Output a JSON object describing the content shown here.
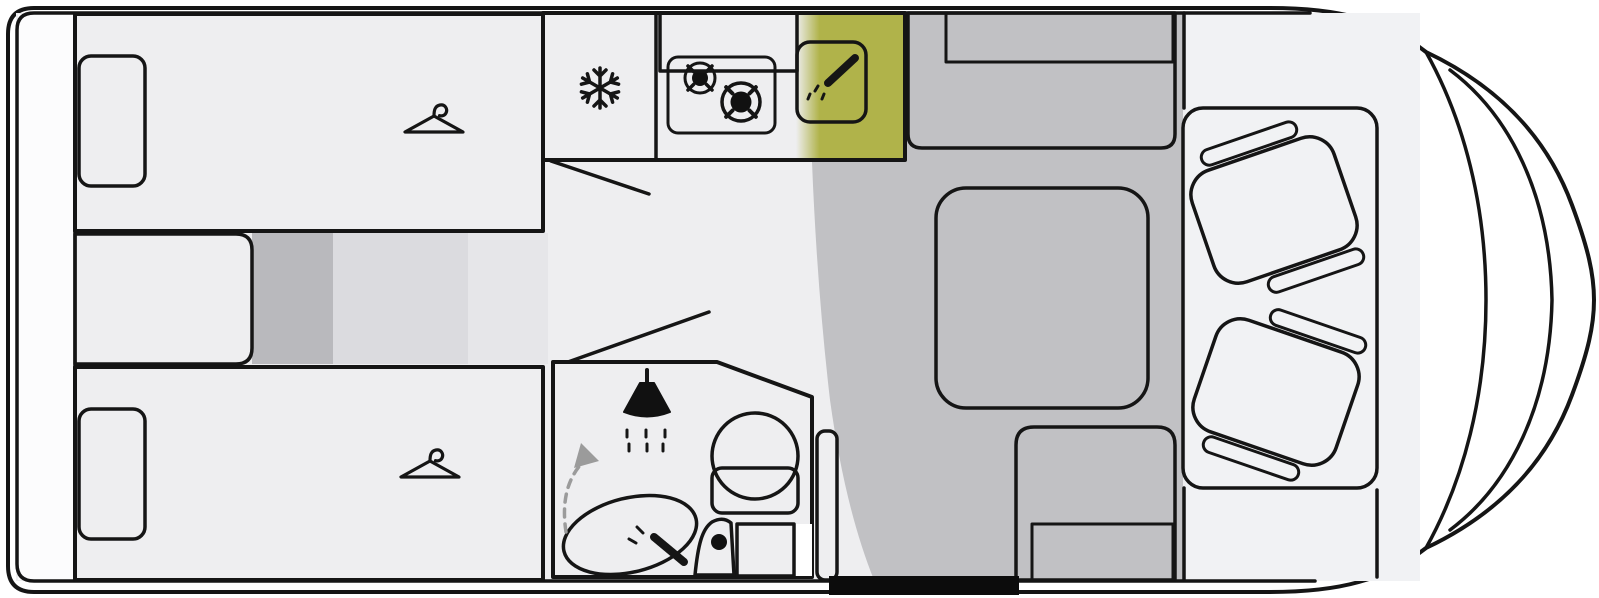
{
  "meta": {
    "title": "Motorhome floor plan",
    "view": "top-down layout diagram",
    "text_labels": []
  },
  "colors": {
    "shell": "#edeff0",
    "floor": "#eeeef0",
    "cab_floor": "#f1f2f4",
    "rear_floor": "#fcfcfd",
    "bed": "#f1f1d9",
    "step_band_dark": "#b9b9bd",
    "step_band_mid": "#dbdbdf",
    "step_band_light": "#e6e6e9",
    "kitchen": "#d5d860",
    "kitchen_shadow": "#b0b34a",
    "bathroom": "#e4e5a1",
    "dinette_floor": "#c1c1c4",
    "bench": "#b5b5b8",
    "bench_cushion": "#c8c8cb",
    "table": "#cdcdd0",
    "seat": "#e4e4e7",
    "white": "#ffffff",
    "entry_door": "#0c0c0c",
    "arrow": "#9b9b9b",
    "icon": "#111111"
  },
  "rooms": {
    "rear_storage": "rear storage strip",
    "bedroom": "twin single beds with wardrobe hangers",
    "kitchen": "kitchen: fridge, two-burner hob, sink",
    "bathroom": "bathroom: shower, washbasin, toilet, swivel wall",
    "dinette": "dinette: bench, table, side bench",
    "cab": "driver cab with two swivel seats",
    "entry": "entry door (black opening, bottom wall)"
  },
  "icons": [
    "hanger-icon",
    "hanger-icon",
    "snowflake-icon",
    "burner-icon",
    "burner-icon",
    "faucet-icon",
    "shower-head-icon",
    "water-drops-icon",
    "swivel-arrow-icon",
    "toilet-icon",
    "washbasin-icon"
  ]
}
